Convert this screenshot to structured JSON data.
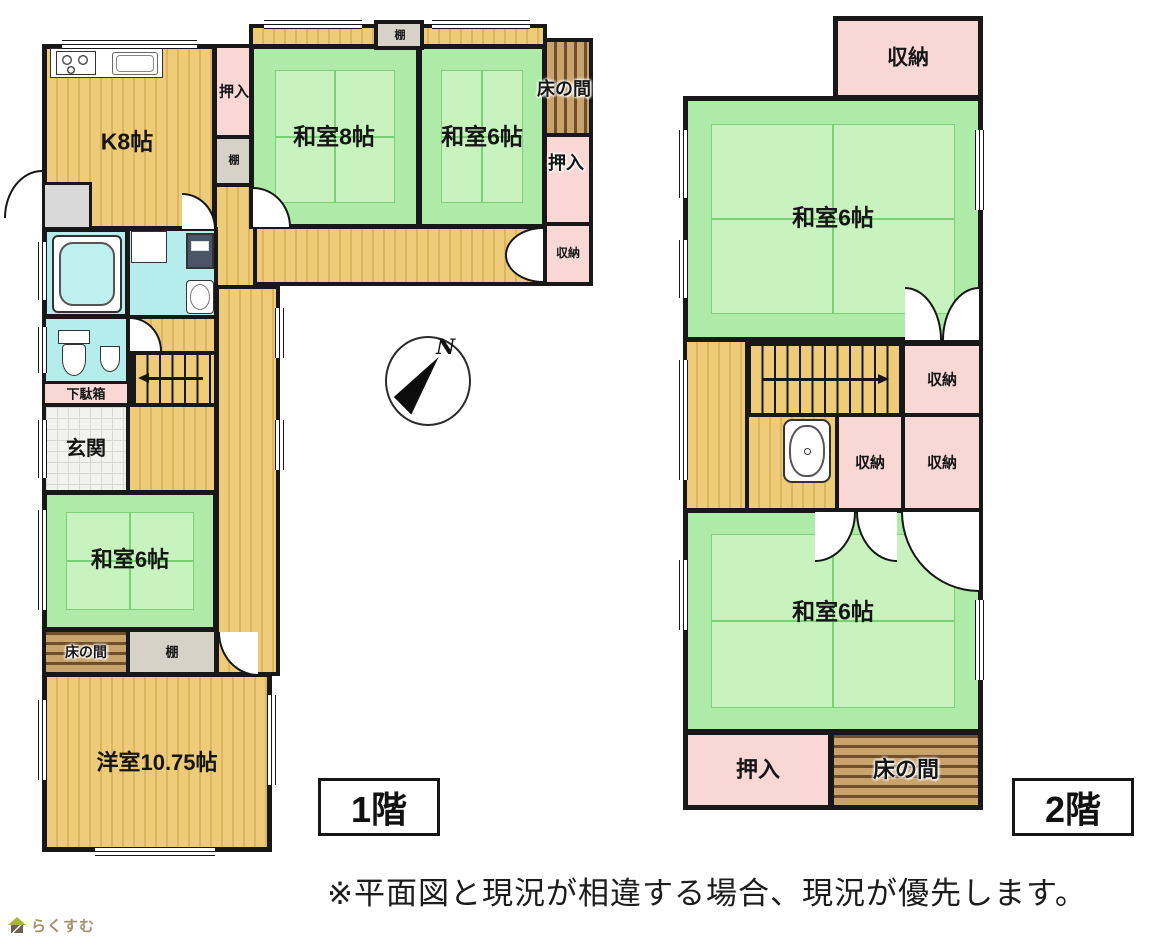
{
  "floor1": {
    "tag": "1階",
    "rooms": {
      "kitchen": "K8帖",
      "oshiire_top": "押入",
      "tana_top": "棚",
      "engawa_tana": "棚",
      "washitsu8": "和室8帖",
      "washitsu6_upper": "和室6帖",
      "tokonoma_right": "床の間",
      "oshiire_right": "押入",
      "shuunou_right": "収納",
      "getabako": "下駄箱",
      "genkan": "玄関",
      "washitsu6_mid": "和室6帖",
      "tokonoma_mid": "床の間",
      "tana_mid": "棚",
      "youshitsu": "洋室10.75帖"
    }
  },
  "floor2": {
    "tag": "2階",
    "rooms": {
      "shuunou_top": "収納",
      "washitsu6_upper": "和室6帖",
      "shuunou_stairs": "収納",
      "shuunou_mid": "収納",
      "shuunou_mid_right": "収納",
      "washitsu6_lower": "和室6帖",
      "oshiire": "押入",
      "tokonoma": "床の間"
    }
  },
  "compass": {
    "north": "N"
  },
  "footer": {
    "disclaimer": "※平面図と現況が相違する場合、現況が優先します。",
    "logo": "らくすむ"
  },
  "colors": {
    "tatami_green": "#aeeaa8",
    "flooring_yellow": "#edcb79",
    "closet_pink": "#f8d7d5",
    "tokonoma_brown": "#6e4e2b",
    "water_cyan": "#b5eded",
    "wall_black": "#181818"
  }
}
